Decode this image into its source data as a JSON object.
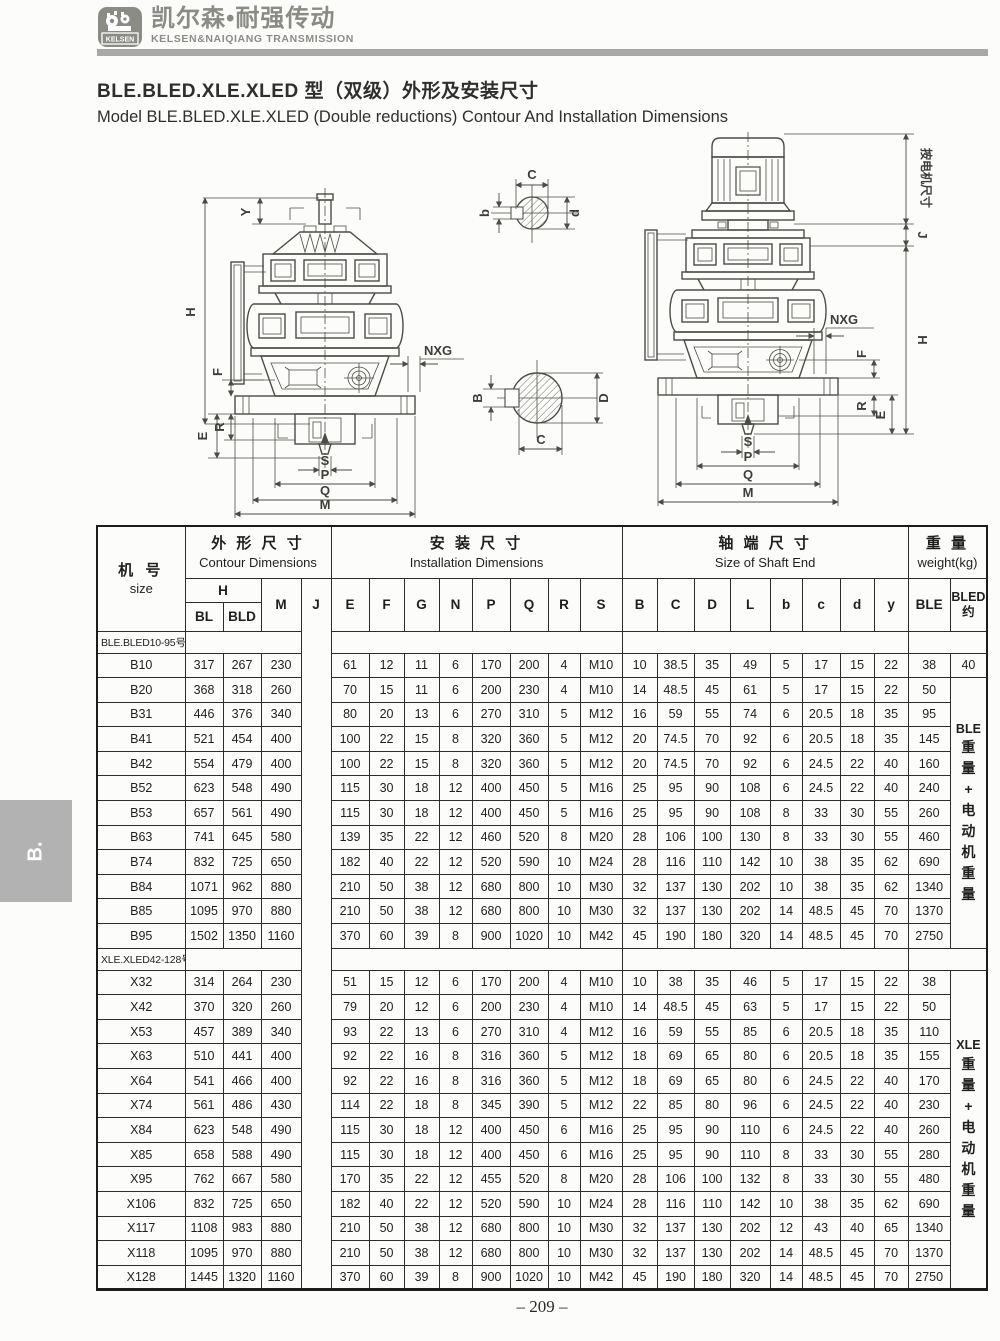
{
  "page": {
    "brand": {
      "logo_badge": "KELSEN",
      "brand_cn": "凯尔森•耐强传动",
      "brand_en": "KELSEN&NAIQIANG TRANSMISSION"
    },
    "title_cn": "BLE.BLED.XLE.XLED 型（双级）外形及安装尺寸",
    "title_en": "Model BLE.BLED.XLE.XLED (Double reductions) Contour And Installation Dimensions",
    "side_tab": "B.",
    "page_number": "– 209 –"
  },
  "drawings": {
    "left": {
      "y": "Y",
      "h": "H",
      "f": "F",
      "r": "R",
      "e": "E",
      "nxg": "NXG",
      "s": "S",
      "p": "P",
      "q": "Q",
      "m": "M"
    },
    "right": {
      "motor_note": "按电机尺寸",
      "j": "J",
      "h": "H",
      "nxg": "NXG",
      "f": "F",
      "r": "R",
      "e": "E",
      "s": "S",
      "p": "P",
      "q": "Q",
      "m": "M"
    },
    "section_top": {
      "c": "C",
      "b": "b",
      "d": "d"
    },
    "section_bottom": {
      "b": "B",
      "d": "D",
      "c": "C"
    }
  },
  "table": {
    "groups": {
      "size_cn": "机 号",
      "size_en": "size",
      "contour_cn": "外 形 尺 寸",
      "contour_en": "Contour Dimensions",
      "install_cn": "安 装 尺 寸",
      "install_en": "Installation Dimensions",
      "shaft_cn": "轴 端 尺 寸",
      "shaft_en": "Size of Shaft End",
      "weight_cn": "重 量",
      "weight_en": "weight(kg)"
    },
    "cols": {
      "h": "H",
      "bl": "BL",
      "bld": "BLD",
      "m": "M",
      "j": "J",
      "e": "E",
      "f": "F",
      "g": "G",
      "n": "N",
      "p": "P",
      "q": "Q",
      "r": "R",
      "s": "S",
      "cap_b": "B",
      "cap_c": "C",
      "cap_d": "D",
      "cap_l": "L",
      "low_b": "b",
      "low_c": "c",
      "low_d": "d",
      "low_y": "y",
      "ble": "BLE",
      "bled_l1": "BLED",
      "bled_l2": "约"
    },
    "sections": [
      {
        "label": "BLE.BLED10-95号",
        "note": "BLE重量+电动机重量",
        "note_row": 1,
        "note_span": 11,
        "rows": [
          {
            "size": "B10",
            "v": [
              "317",
              "267",
              "230",
              "61",
              "12",
              "11",
              "6",
              "170",
              "200",
              "4",
              "M10",
              "10",
              "38.5",
              "35",
              "49",
              "5",
              "17",
              "15",
              "22"
            ],
            "ble": "38",
            "bled": "40"
          },
          {
            "size": "B20",
            "v": [
              "368",
              "318",
              "260",
              "70",
              "15",
              "11",
              "6",
              "200",
              "230",
              "4",
              "M10",
              "14",
              "48.5",
              "45",
              "61",
              "5",
              "17",
              "15",
              "22"
            ],
            "ble": "50"
          },
          {
            "size": "B31",
            "v": [
              "446",
              "376",
              "340",
              "80",
              "20",
              "13",
              "6",
              "270",
              "310",
              "5",
              "M12",
              "16",
              "59",
              "55",
              "74",
              "6",
              "20.5",
              "18",
              "35"
            ],
            "ble": "95"
          },
          {
            "size": "B41",
            "v": [
              "521",
              "454",
              "400",
              "100",
              "22",
              "15",
              "8",
              "320",
              "360",
              "5",
              "M12",
              "20",
              "74.5",
              "70",
              "92",
              "6",
              "20.5",
              "18",
              "35"
            ],
            "ble": "145"
          },
          {
            "size": "B42",
            "v": [
              "554",
              "479",
              "400",
              "100",
              "22",
              "15",
              "8",
              "320",
              "360",
              "5",
              "M12",
              "20",
              "74.5",
              "70",
              "92",
              "6",
              "24.5",
              "22",
              "40"
            ],
            "ble": "160"
          },
          {
            "size": "B52",
            "v": [
              "623",
              "548",
              "490",
              "115",
              "30",
              "18",
              "12",
              "400",
              "450",
              "5",
              "M16",
              "25",
              "95",
              "90",
              "108",
              "6",
              "24.5",
              "22",
              "40"
            ],
            "ble": "240"
          },
          {
            "size": "B53",
            "v": [
              "657",
              "561",
              "490",
              "115",
              "30",
              "18",
              "12",
              "400",
              "450",
              "5",
              "M16",
              "25",
              "95",
              "90",
              "108",
              "8",
              "33",
              "30",
              "55"
            ],
            "ble": "260"
          },
          {
            "size": "B63",
            "v": [
              "741",
              "645",
              "580",
              "139",
              "35",
              "22",
              "12",
              "460",
              "520",
              "8",
              "M20",
              "28",
              "106",
              "100",
              "130",
              "8",
              "33",
              "30",
              "55"
            ],
            "ble": "460"
          },
          {
            "size": "B74",
            "v": [
              "832",
              "725",
              "650",
              "182",
              "40",
              "22",
              "12",
              "520",
              "590",
              "10",
              "M24",
              "28",
              "116",
              "110",
              "142",
              "10",
              "38",
              "35",
              "62"
            ],
            "ble": "690"
          },
          {
            "size": "B84",
            "v": [
              "1071",
              "962",
              "880",
              "210",
              "50",
              "38",
              "12",
              "680",
              "800",
              "10",
              "M30",
              "32",
              "137",
              "130",
              "202",
              "10",
              "38",
              "35",
              "62"
            ],
            "ble": "1340"
          },
          {
            "size": "B85",
            "v": [
              "1095",
              "970",
              "880",
              "210",
              "50",
              "38",
              "12",
              "680",
              "800",
              "10",
              "M30",
              "32",
              "137",
              "130",
              "202",
              "14",
              "48.5",
              "45",
              "70"
            ],
            "ble": "1370"
          },
          {
            "size": "B95",
            "v": [
              "1502",
              "1350",
              "1160",
              "370",
              "60",
              "39",
              "8",
              "900",
              "1020",
              "10",
              "M42",
              "45",
              "190",
              "180",
              "320",
              "14",
              "48.5",
              "45",
              "70"
            ],
            "ble": "2750"
          }
        ]
      },
      {
        "label": "XLE.XLED42-128号",
        "note": "XLE重量+电动机重量",
        "note_row": 0,
        "note_span": 13,
        "rows": [
          {
            "size": "X32",
            "v": [
              "314",
              "264",
              "230",
              "51",
              "15",
              "12",
              "6",
              "170",
              "200",
              "4",
              "M10",
              "10",
              "38",
              "35",
              "46",
              "5",
              "17",
              "15",
              "22"
            ],
            "ble": "38"
          },
          {
            "size": "X42",
            "v": [
              "370",
              "320",
              "260",
              "79",
              "20",
              "12",
              "6",
              "200",
              "230",
              "4",
              "M10",
              "14",
              "48.5",
              "45",
              "63",
              "5",
              "17",
              "15",
              "22"
            ],
            "ble": "50"
          },
          {
            "size": "X53",
            "v": [
              "457",
              "389",
              "340",
              "93",
              "22",
              "13",
              "6",
              "270",
              "310",
              "4",
              "M12",
              "16",
              "59",
              "55",
              "85",
              "6",
              "20.5",
              "18",
              "35"
            ],
            "ble": "110"
          },
          {
            "size": "X63",
            "v": [
              "510",
              "441",
              "400",
              "92",
              "22",
              "16",
              "8",
              "316",
              "360",
              "5",
              "M12",
              "18",
              "69",
              "65",
              "80",
              "6",
              "20.5",
              "18",
              "35"
            ],
            "ble": "155"
          },
          {
            "size": "X64",
            "v": [
              "541",
              "466",
              "400",
              "92",
              "22",
              "16",
              "8",
              "316",
              "360",
              "5",
              "M12",
              "18",
              "69",
              "65",
              "80",
              "6",
              "24.5",
              "22",
              "40"
            ],
            "ble": "170"
          },
          {
            "size": "X74",
            "v": [
              "561",
              "486",
              "430",
              "114",
              "22",
              "18",
              "8",
              "345",
              "390",
              "5",
              "M12",
              "22",
              "85",
              "80",
              "96",
              "6",
              "24.5",
              "22",
              "40"
            ],
            "ble": "230"
          },
          {
            "size": "X84",
            "v": [
              "623",
              "548",
              "490",
              "115",
              "30",
              "18",
              "12",
              "400",
              "450",
              "6",
              "M16",
              "25",
              "95",
              "90",
              "110",
              "6",
              "24.5",
              "22",
              "40"
            ],
            "ble": "260"
          },
          {
            "size": "X85",
            "v": [
              "658",
              "588",
              "490",
              "115",
              "30",
              "18",
              "12",
              "400",
              "450",
              "6",
              "M16",
              "25",
              "95",
              "90",
              "110",
              "8",
              "33",
              "30",
              "55"
            ],
            "ble": "280"
          },
          {
            "size": "X95",
            "v": [
              "762",
              "667",
              "580",
              "170",
              "35",
              "22",
              "12",
              "455",
              "520",
              "8",
              "M20",
              "28",
              "106",
              "100",
              "132",
              "8",
              "33",
              "30",
              "55"
            ],
            "ble": "480"
          },
          {
            "size": "X106",
            "v": [
              "832",
              "725",
              "650",
              "182",
              "40",
              "22",
              "12",
              "520",
              "590",
              "10",
              "M24",
              "28",
              "116",
              "110",
              "142",
              "10",
              "38",
              "35",
              "62"
            ],
            "ble": "690"
          },
          {
            "size": "X117",
            "v": [
              "1108",
              "983",
              "880",
              "210",
              "50",
              "38",
              "12",
              "680",
              "800",
              "10",
              "M30",
              "32",
              "137",
              "130",
              "202",
              "12",
              "43",
              "40",
              "65"
            ],
            "ble": "1340"
          },
          {
            "size": "X118",
            "v": [
              "1095",
              "970",
              "880",
              "210",
              "50",
              "38",
              "12",
              "680",
              "800",
              "10",
              "M30",
              "32",
              "137",
              "130",
              "202",
              "14",
              "48.5",
              "45",
              "70"
            ],
            "ble": "1370"
          },
          {
            "size": "X128",
            "v": [
              "1445",
              "1320",
              "1160",
              "370",
              "60",
              "39",
              "8",
              "900",
              "1020",
              "10",
              "M42",
              "45",
              "190",
              "180",
              "320",
              "14",
              "48.5",
              "45",
              "70"
            ],
            "ble": "2750"
          }
        ]
      }
    ]
  }
}
